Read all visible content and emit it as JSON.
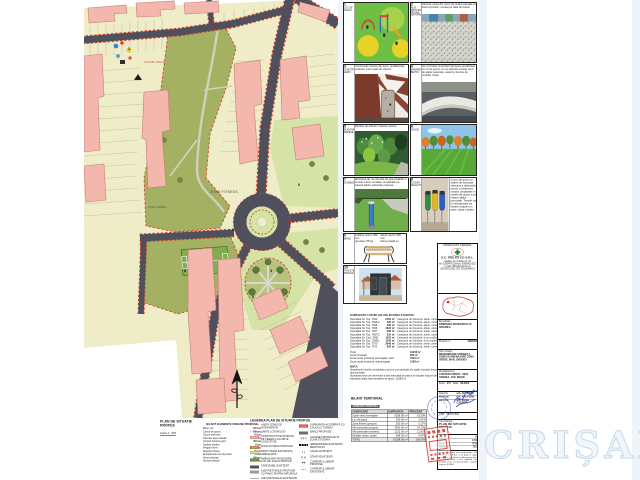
{
  "page": {
    "watermark": "CRIȘANA"
  },
  "map": {
    "labels": {
      "zona_fitness": "ZONA FITNESS",
      "loc_joaca": "LOC DE JOACA",
      "zona_verde": "ZONA VERDE"
    },
    "markers": {
      "m1": "1",
      "m3": "3",
      "m4": "4",
      "m6": "6",
      "m8": "8",
      "m9": "9"
    }
  },
  "plan": {
    "title": "PLAN DE SITUATIE PROPUS",
    "scale": "scara   1 : 500"
  },
  "elements": {
    "title": "BILANT ELEMENTE URBANE PROPUSE",
    "items": [
      {
        "label": "Banci noi",
        "value": "32 buc"
      },
      {
        "label": "Cosuri de gunoi",
        "value": "28 buc"
      },
      {
        "label": "Cosuri selective",
        "value": "6 buc"
      },
      {
        "label": "Cismele apa potabila",
        "value": "2 buc"
      },
      {
        "label": "Corpuri iluminat parc",
        "value": "46 buc"
      },
      {
        "label": "Toalete publice",
        "value": "1 buc"
      },
      {
        "label": "Pergole lemn",
        "value": "2 buc"
      },
      {
        "label": "Aparate fitness",
        "value": "8 buc"
      },
      {
        "label": "Echipamente loc de joaca",
        "value": "6 buc"
      },
      {
        "label": "Arbori plantati",
        "value": "54 buc"
      },
      {
        "label": "Arbusti plantati",
        "value": "120 buc"
      }
    ]
  },
  "legend": {
    "title": "LEGENDA PLAN DE SITUATIE PROPUS",
    "left": [
      {
        "label": "LIMITA ZONEI DE INTERVENTIE"
      },
      {
        "label": "LIMITE LOTURI (CF)"
      },
      {
        "label": "CONSTRUCTII EXISTENTE PE TEREN (LOCUINTE COLECTIVE)"
      },
      {
        "label": "ZONA FITNESS PROPUSA"
      },
      {
        "label": "SPATII VERZI EXISTENTE, AMENAJATE"
      },
      {
        "label": "AMENAJARI PEISAGERE, LOC DE JOACA PROPUS"
      },
      {
        "label": "CAROSABIL EXISTENT"
      },
      {
        "label": "ALEI PIETONALE PROPUSE CU PAVAJ PIATRA NATURALA"
      },
      {
        "label": "ALEI PIETONALE EXISTENTE, MENTINUTE"
      }
    ],
    "right": [
      {
        "glyph": "",
        "label": "SUPRAFATA ACOPERITA CU CAUCIUC TURNAT"
      },
      {
        "glyph": "",
        "label": "BANCI PROPUSE"
      },
      {
        "glyph": "∨∨∨",
        "label": "ACCESE PIETONALE IN ZONA STUDIATA"
      },
      {
        "glyph": "",
        "label": "IMPREJMUIRE EXISTENTA MENTINUTA"
      },
      {
        "glyph": "[  ]",
        "label": "CANAL EXISTENT"
      },
      {
        "glyph": "O  O",
        "label": "STALPI EXISTENTI"
      },
      {
        "glyph": "◂•▸",
        "label": "CORPURI ILUMINAT PROPUSE"
      },
      {
        "glyph": "• • •",
        "label": "CORPURI ILUMINAT EXISTENTE"
      }
    ]
  },
  "panels": {
    "p1": {
      "num": "1",
      "label": "LOC DE JOACA",
      "caption": ""
    },
    "p2": {
      "num": "2",
      "label": "ALEI PIETONALE PIATRA NATURALA",
      "caption": "Strat de uzura din covor de piatra naturala cu lianti epoxidici, montat pe dala din beton"
    },
    "p3": {
      "num": "3",
      "label": "CONSTRUCTII LEMN",
      "caption": "Constructie usoara din lemn, prefabricata modular. Foto luata din interior"
    },
    "p4": {
      "num": "4",
      "label": "PARAPETI BETON",
      "caption": "Se vor folosi ca borduri din beton prefabricat cu rol de sezut, ce vor delimita zonele verzi de aleile pietonale, avand si functie de mobilier urban"
    },
    "p5": {
      "num": "5",
      "label": "PLANTARI PERENE",
      "caption": "Plantari de arbusti si plante perene"
    },
    "p6": {
      "num": "6",
      "label": "GAZON",
      "caption": ""
    },
    "p7": {
      "num": "7",
      "label": "CISMELE",
      "caption": "Montarea de noi cismele de apa potabila in zonele intens circulate, amplasate pe traseul aleilor pietonale propuse"
    },
    "p8": {
      "num": "8",
      "label": "COSURI SELECTIVE",
      "caption": "Cosuri de gunoi cu sistem de colectare selectiva a deseurilor, pentru o intretinere usoara, amplasate in zonele de acces si pe traseul aleilor principale. Textele vor fi inscriptionate pe fiecare recipient in parte, dupa culoare."
    },
    "p9": {
      "num": "9",
      "label": "BANCI",
      "specs_left": "inaltime sezut: 450 mm\ngreutate: 85 kg\nsuprafata de acoperire: 3.00 m",
      "specs_right": "latime sezut: 530 mm\nlatime totala cu brate: 700 mm\nmaterial: lemn + metal"
    },
    "p10": {
      "num": "10",
      "label": "TOALETE PUBLICE",
      "caption": ""
    }
  },
  "parcels": {
    "title": "SUPRAFETE LOTURI AFLATE IN ZONA STUDIATA:",
    "rows": [
      {
        "label": "Suprafata Nr. Top. 7064",
        "area": "2150 m²",
        "cat": "Categoria de folosinta: altele, cartea funciara nr. 157237"
      },
      {
        "label": "Suprafata Nr. Top. 7064/2",
        "area": "320 m²",
        "cat": "Categoria de folosinta: altele, cartea funciara nr. 160200"
      },
      {
        "label": "Suprafata Nr. Top. 7065",
        "area": "180 m²",
        "cat": "Categoria de folosinta: altele, cartea funciara nr. 157238"
      },
      {
        "label": "Suprafata Nr. Top. 7066",
        "area": "1022 m²",
        "cat": "Categoria de folosinta: altele, cartea funciara nr. 152945"
      },
      {
        "label": "Suprafata Nr. Top. 7067",
        "area": "228 m²",
        "cat": "Categoria de folosinta: altele, cartea funciara nr. 157244"
      },
      {
        "label": "Suprafata Nr. Top. 7067/2",
        "area": "535 m²",
        "cat": "Categoria de folosinta: altele, cartea funciara nr. 157246"
      },
      {
        "label": "Suprafata Nr. Cad. 7068",
        "area": "1025 m²",
        "cat": "Categoria de folosinta: drum public, cartea funciara nr. 199586"
      },
      {
        "label": "Suprafata Nr. Top. 7069/1",
        "area": "1340 m²",
        "cat": "Categoria de folosinta: drum public, cartea funciara nr. 169018"
      },
      {
        "label": "Suprafata Nr. Top. 7070",
        "area": "2608 m²",
        "cat": "Categoria de folosinta: altele, cartea funciara nr. 157249"
      },
      {
        "label": "Suprafata Nr. Top. 7071",
        "area": "850 m²",
        "cat": "Categoria de folosinta: altele, cartea funciara nr. 85941"
      }
    ],
    "totals": [
      {
        "label": "Total",
        "value": "10258 m²"
      },
      {
        "label": "Zona Circulatii",
        "value": "850 m²"
      },
      {
        "label": "Zona verde existenta amenajata, total",
        "value": "7840 m²"
      },
      {
        "label": "Zona verde existenta neamenajata",
        "value": "1568 m²"
      }
    ],
    "nota_label": "NOTA:",
    "nota1": "Suprafetele loturilor mentionate mai sus sunt preluate din cartile funciare anexate la prezenta documentatie.",
    "nota2": "Suprafata zonei de interventie a fost masurata pe planul de situatie intocmit de proiectant, rezultand o suprafata totala reprezentativa de aprox. 10258 m²."
  },
  "bilant": {
    "title": "BILANT TERITORIAL",
    "subtitle": "VARIANTA PROPUSA",
    "headers": [
      "ZONIFICARE",
      "SUPRAFATA",
      "PROCENT"
    ],
    "rows": [
      {
        "name": "Spatii verzi amenajate",
        "area": "6258.00 m²",
        "pct": "61.00%"
      },
      {
        "name": "Loc de joaca",
        "area": "350.00 m²",
        "pct": "3.41%"
      },
      {
        "name": "Zona fitness (propus)",
        "area": "530.00 m²",
        "pct": "5.17%"
      },
      {
        "name": "Alei pietonale (propus)",
        "area": "1450.00 m²",
        "pct": "14.13%"
      },
      {
        "name": "Alei pietonale (existent)",
        "area": "1212.00 m²",
        "pct": "11.82%"
      },
      {
        "name": "Mobilier urban, dotari",
        "area": "458.00 m²",
        "pct": "4.47%"
      }
    ],
    "total": {
      "label": "TOTAL",
      "area": "10258.00 m²",
      "pct": "100.00%"
    }
  },
  "cartus": {
    "proiectant_label": "PROIECTANT GENERAL",
    "company": "S.C. PRO EX CO S.R.L.",
    "company_lines": "Oradea, str. Artarilor nr. 20\ntel: 0259/476.158  fax: 0359/410.522\ne-mail: office@proexco.ro\nJ05/1021/2002   CUI: RO14958710",
    "beneficiar_label": "Beneficiar:",
    "beneficiar": "PRIMARIA MUNICIPIULUI ORADEA",
    "proiect_nr_label": "Proiect nr.:",
    "proiect_nr": "208/2022",
    "titlu_proiect_label": "Titlu proiect:",
    "titlu_proiect": "REGENERARE URBANA A ZONEI SI AMENAJARE ZONA VERDE, MUN. ORADEA",
    "amplasament_label": "Amplasament:",
    "amplasament": "CARTIER EUROPA - MUN. ORADEA, JUD. BIHOR",
    "faza_label": "Faza:",
    "faza": "D.T.",
    "data_label": "Data:",
    "data": "08.2022",
    "staff": [
      {
        "role": "Intocmit",
        "name": "arh. Alin POPA"
      },
      {
        "role": "Proiectat",
        "name": "arh. Alin POPA"
      },
      {
        "role": "Desenat",
        "name": "arh. Kinga CSORBA"
      }
    ],
    "data2_label": "Data:",
    "data2": "08.05.2022",
    "titlu_plansa_label": "Titlu Plansa:",
    "titlu_plansa": "PLAN DE SITUATIE PROPUS",
    "grid": {
      "format_label": "Format",
      "format": "A3",
      "scara_label": "Scara",
      "scara": "1:500",
      "faza2_label": "Faza",
      "faza2": "P.Th.",
      "plansa_label": "Plansa nr.",
      "plansa": "02.A"
    },
    "nota": "Acest document este proprietatea S.C. PRO EX CO S.R.L. si nu poate fi copiat, multiplicat sau folosit in alte scopuri decat cel pentru care a fost elaborat, fara acordul scris al proiectantului. Conform Legii nr. 8/1996."
  }
}
